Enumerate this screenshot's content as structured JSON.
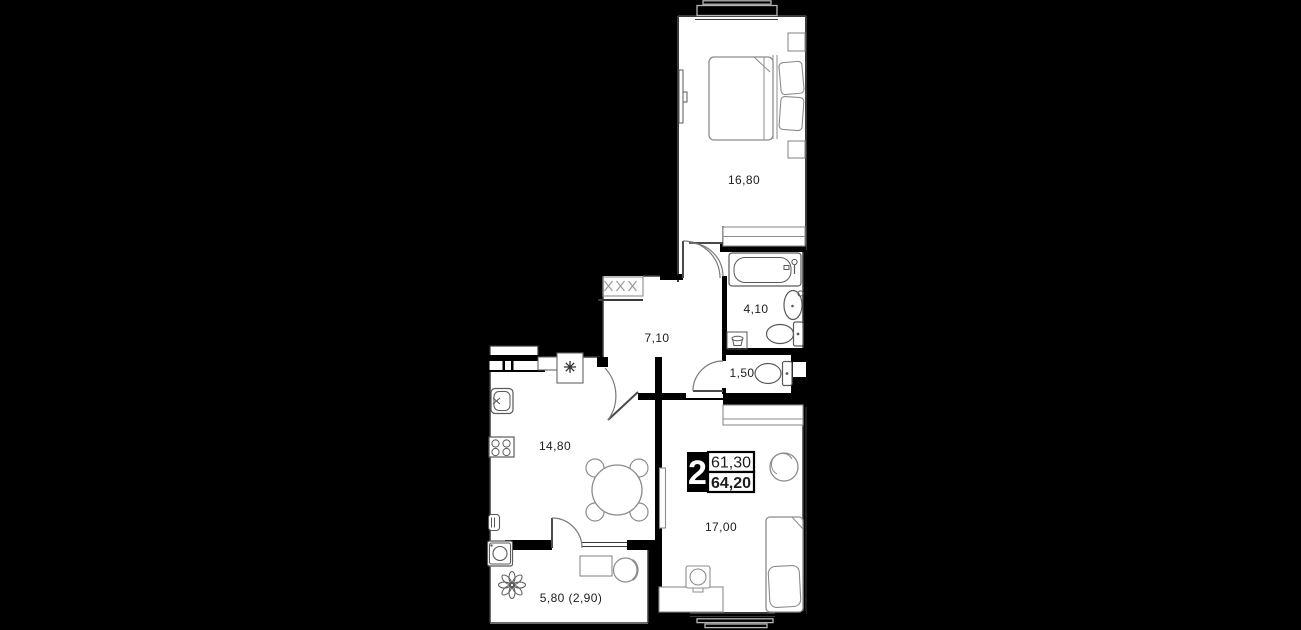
{
  "plan": {
    "title": "2-room apartment floor plan",
    "badge": {
      "rooms_count": "2",
      "area_living": "61,30",
      "area_total": "64,20"
    },
    "rooms": {
      "bedroom": {
        "label": "16,80"
      },
      "bathroom": {
        "label": "4,10"
      },
      "wc": {
        "label": "1,50"
      },
      "hallway": {
        "label": "7,10"
      },
      "kitchen": {
        "label": "14,80"
      },
      "living": {
        "label": "17,00"
      },
      "balcony": {
        "label": "5,80 (2,90)"
      }
    },
    "colors": {
      "background": "#000000",
      "floor": "#ffffff",
      "wall_line": "#3a3a3a",
      "furniture_line": "#8c8c8c",
      "fixture_line": "#5a5a5a",
      "rail_line": "#b5b5b5",
      "text": "#1c1c1c",
      "badge_bg": "#000000",
      "badge_text": "#ffffff"
    }
  }
}
